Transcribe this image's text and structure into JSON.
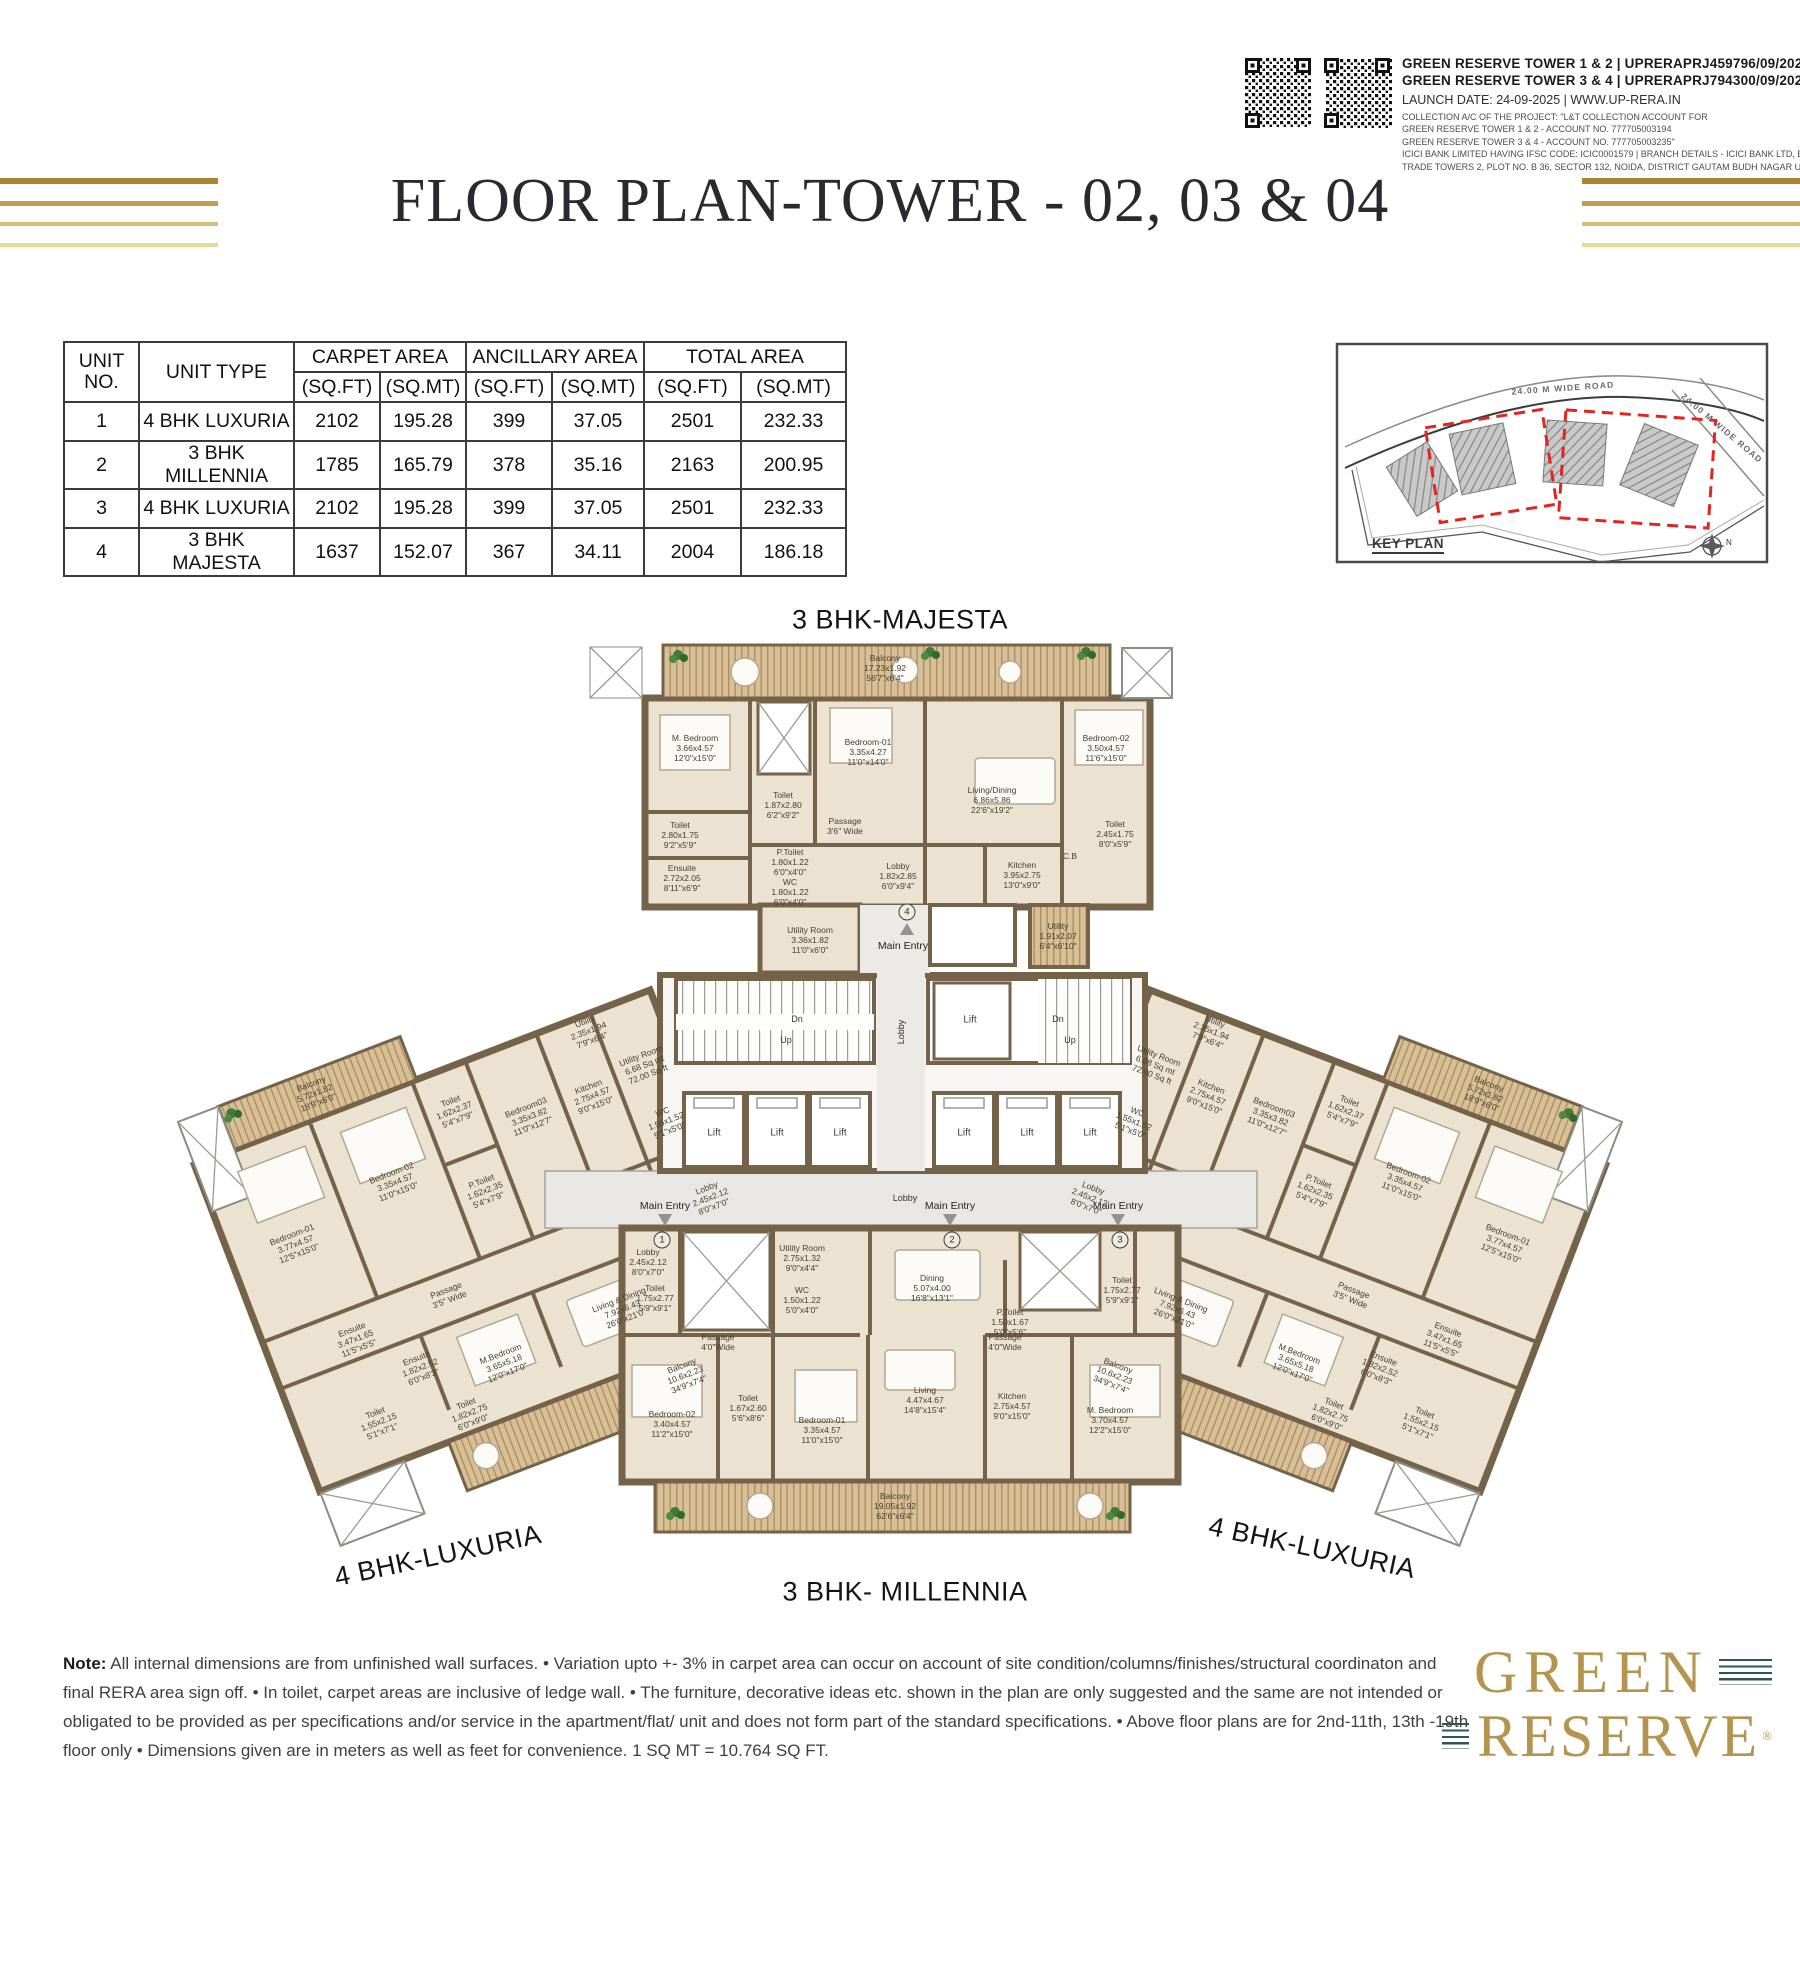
{
  "header": {
    "reg_line_1": "GREEN RESERVE TOWER 1 & 2 | UPRERAPRJ459796/09/2025",
    "reg_line_2": "GREEN RESERVE TOWER 3 & 4 | UPRERAPRJ794300/09/2025",
    "launch_line": "LAUNCH DATE: 24-09-2025 | WWW.UP-RERA.IN",
    "collection_lines": [
      "COLLECTION A/C OF THE PROJECT: \"L&T COLLECTION ACCOUNT FOR",
      "GREEN RESERVE TOWER 1 & 2 - ACCOUNT NO. 777705003194",
      "GREEN RESERVE TOWER 3 & 4 - ACCOUNT NO. 777705003235\"",
      "ICICI BANK LIMITED HAVING IFSC CODE: ICIC0001579 | BRANCH DETAILS - ICICI BANK LTD, EXPRESS",
      "TRADE TOWERS 2, PLOT NO. B 36, SECTOR 132, NOIDA, DISTRICT GAUTAM BUDH NAGAR UP-201304"
    ],
    "title": "FLOOR PLAN-TOWER - 02, 03 & 04"
  },
  "area_table": {
    "unit_no_header": "UNIT\nNO.",
    "unit_type_header": "UNIT TYPE",
    "groups": [
      "CARPET AREA",
      "ANCILLARY AREA",
      "TOTAL AREA"
    ],
    "sub_ft": "(SQ.FT)",
    "sub_mt": "(SQ.MT)",
    "rows": [
      [
        "1",
        "4 BHK LUXURIA",
        "2102",
        "195.28",
        "399",
        "37.05",
        "2501",
        "232.33"
      ],
      [
        "2",
        "3 BHK MILLENNIA",
        "1785",
        "165.79",
        "378",
        "35.16",
        "2163",
        "200.95"
      ],
      [
        "3",
        "4 BHK LUXURIA",
        "2102",
        "195.28",
        "399",
        "37.05",
        "2501",
        "232.33"
      ],
      [
        "4",
        "3 BHK MAJESTA",
        "1637",
        "152.07",
        "367",
        "34.11",
        "2004",
        "186.18"
      ]
    ]
  },
  "key_plan": {
    "label": "KEY PLAN",
    "road_top": "24.00 M WIDE ROAD",
    "road_right": "24.00 M WIDE ROAD",
    "north": "N"
  },
  "floor_plan": {
    "unit_titles": {
      "majesta": "3 BHK-MAJESTA",
      "luxuria_left": "4 BHK-LUXURIA",
      "millennia": "3 BHK- MILLENNIA",
      "luxuria_right": "4 BHK-LUXURIA"
    },
    "core": {
      "lift": "Lift",
      "lobby": "Lobby",
      "up": "Up",
      "dn": "Dn",
      "main_entry": "Main Entry",
      "entry_1": "1",
      "entry_2": "2",
      "entry_3": "3",
      "entry_4": "4"
    },
    "majesta_rooms": [
      "Balcony\n17.23x1.92\n56'7\"x6'4\"",
      "M. Bedroom\n3.66x4.57\n12'0\"x15'0\"",
      "Toilet\n1.87x2.80\n6'2\"x9'2\"",
      "Bedroom-01\n3.35x4.27\n11'0\"x14'0\"",
      "Living/Dining\n6.86x5.86\n22'6\"x19'2\"",
      "Bedroom-02\n3.50x4.57\n11'6\"x15'0\"",
      "Toilet\n2.80x1.75\n9'2\"x5'9\"",
      "Ensuite\n2.72x2.05\n8'11\"x6'9\"",
      "Passage\n3'6\" Wide",
      "P.Toilet\n1.80x1.22\n6'0\"x4'0\"",
      "WC\n1.80x1.22\n6'0\"x4'0\"",
      "Lobby\n1.82x2.85\n6'0\"x9'4\"",
      "Kitchen\n3.95x2.75\n13'0\"x9'0\"",
      "Toilet\n2.45x1.75\n8'0\"x5'9\"",
      "C.B",
      "Utility\n1.91x2.07\n6'4\"x6'10\"",
      "Utility Room\n3.36x1.82\n11'0\"x6'0\""
    ],
    "millennia_rooms": [
      "Lobby\n2.45x2.12\n8'0\"x7'0\"",
      "Toilet\n1.75x2.77\n5'9\"x9'1\"",
      "Utility Room\n2.75x1.32\n9'0\"x4'4\"",
      "WC\n1.50x1.22\n5'0\"x4'0\"",
      "Dining\n5.07x4.00\n16'8\"x13'1\"",
      "P.Toilet\n1.50x1.67\n5'0\"x5'6\"",
      "Toilet\n1.75x2.77\n5'9\"x9'1\"",
      "Passage\n4'0\"Wide",
      "Passage\n4'0\"Wide",
      "Bedroom-02\n3.40x4.57\n11'2\"x15'0\"",
      "Toilet\n1.67x2.60\n5'6\"x8'6\"",
      "Bedroom-01\n3.35x4.57\n11'0\"x15'0\"",
      "Living\n4.47x4.67\n14'8\"x15'4\"",
      "Kitchen\n2.75x4.57\n9'0\"x15'0\"",
      "M. Bedroom\n3.70x4.57\n12'2\"x15'0\"",
      "Balcony\n19.05x1.92\n62'6\"x6'4\""
    ],
    "luxuria_rooms": [
      "Balcony\n5.72x1.82\n18'9\"x6'0\"",
      "Bedroom-01\n3.77x4.57\n12'5\"x15'0\"",
      "Bedroom-02\n3.35x4.57\n11'0\"x15'0\"",
      "Toilet\n1.62x2.37\n5'4\"x7'9\"",
      "P.Toilet\n1.62x2.35\n5'4\"x7'9\"",
      "Bedroom03\n3.35x3.82\n11'0\"x12'7\"",
      "Kitchen\n2.75x4.57\n9'0\"x15'0\"",
      "Utility\n2.35x1.94\n7'9\"x6'4\"",
      "Utility Room\n6.68 Sq mt\n72.00 Sq ft",
      "WC\n1.55x1.52\n5'1\"x5'0\"",
      "Lobby\n2.45x2.12\n8'0\"x7'0\"",
      "Passage\n3'5\" Wide",
      "Ensuite\n3.47x1.65\n11'5\"x5'5\"",
      "Ensuite\n1.82x2.52\n6'0\"x8'3\"",
      "M.Bedroom\n3.65x5.18\n12'0\"x17'0\"",
      "Toilet\n1.55x2.15\n5'1\"x7'1\"",
      "Toilet\n1.82x2.75\n6'0\"x9'0\"",
      "Living & Dining\n7.92x6.43\n26'0\"x21'0\"",
      "Balcony\n10.6x2.23\n34'9\"x7'4\""
    ]
  },
  "note": {
    "label": "Note:",
    "body": " All internal dimensions are from unfinished wall surfaces. • Variation upto +- 3% in carpet area can occur on account of site condition/columns/finishes/structural coordinaton and final RERA area sign off. • In toilet, carpet areas are inclusive of ledge wall. • The furniture, decorative ideas etc. shown in the plan are only suggested and the same are not intended or obligated to be provided as per specifications and/or service in the apartment/flat/ unit and does not form part of the standard specifications. • Above floor plans are for 2nd-11th, 13th -19th floor only • Dimensions given are in meters as well as feet for convenience. 1 SQ MT = 10.764 SQ FT."
  },
  "logo": {
    "green": "GREEN",
    "reserve": "RESERVE",
    "reg": "®"
  }
}
